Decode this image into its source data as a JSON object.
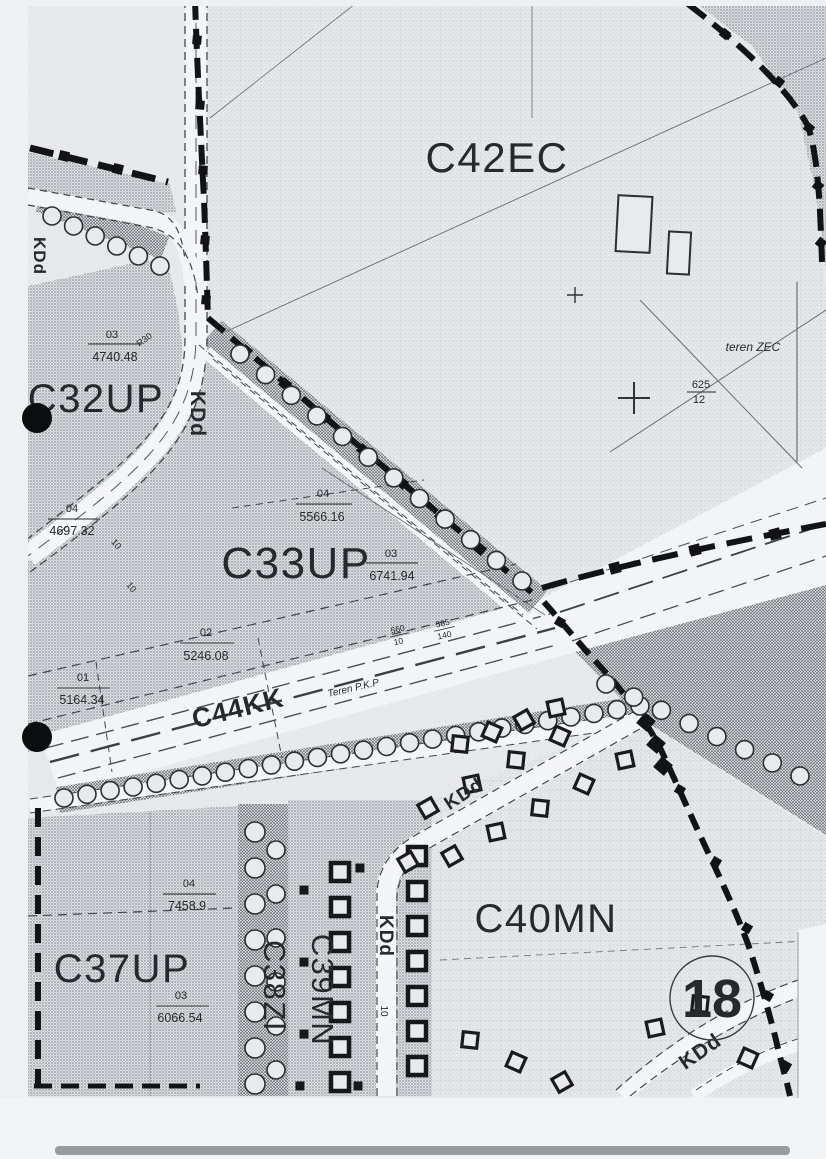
{
  "zones": {
    "c42ec": "C42EC",
    "c32up": "C32UP",
    "c33up": "C33UP",
    "c37up": "C37UP",
    "c38zi": "C38ZI",
    "c39mn": "C39MN",
    "c40mn": "C40MN",
    "c44kk": "C44KK"
  },
  "roads": {
    "kdd": "KDd"
  },
  "terrain": {
    "zec": "teren ZEC",
    "pkp": "Teren P.K.P"
  },
  "sheet_number": "18",
  "parcels": {
    "c32up": [
      {
        "no": "03",
        "area": "4740.48"
      },
      {
        "no": "04",
        "area": "4697.32"
      }
    ],
    "c33up": [
      {
        "no": "04",
        "area": "5566.16"
      },
      {
        "no": "03",
        "area": "6741.94"
      },
      {
        "no": "02",
        "area": "5246.08"
      },
      {
        "no": "01",
        "area": "5164.34"
      }
    ],
    "c37up": [
      {
        "no": "04",
        "area": "7458.9"
      },
      {
        "no": "03",
        "area": "6066.54"
      }
    ]
  },
  "plots": [
    {
      "num": "625",
      "den": "12"
    },
    {
      "num": "560",
      "den": "10"
    },
    {
      "num": "585",
      "den": "140"
    }
  ],
  "dimensions": {
    "width": "10",
    "radius": "R30"
  },
  "colors": {
    "ink": "#17181a",
    "paper": "#e8eaed",
    "corridor": "#f2f4f6"
  }
}
